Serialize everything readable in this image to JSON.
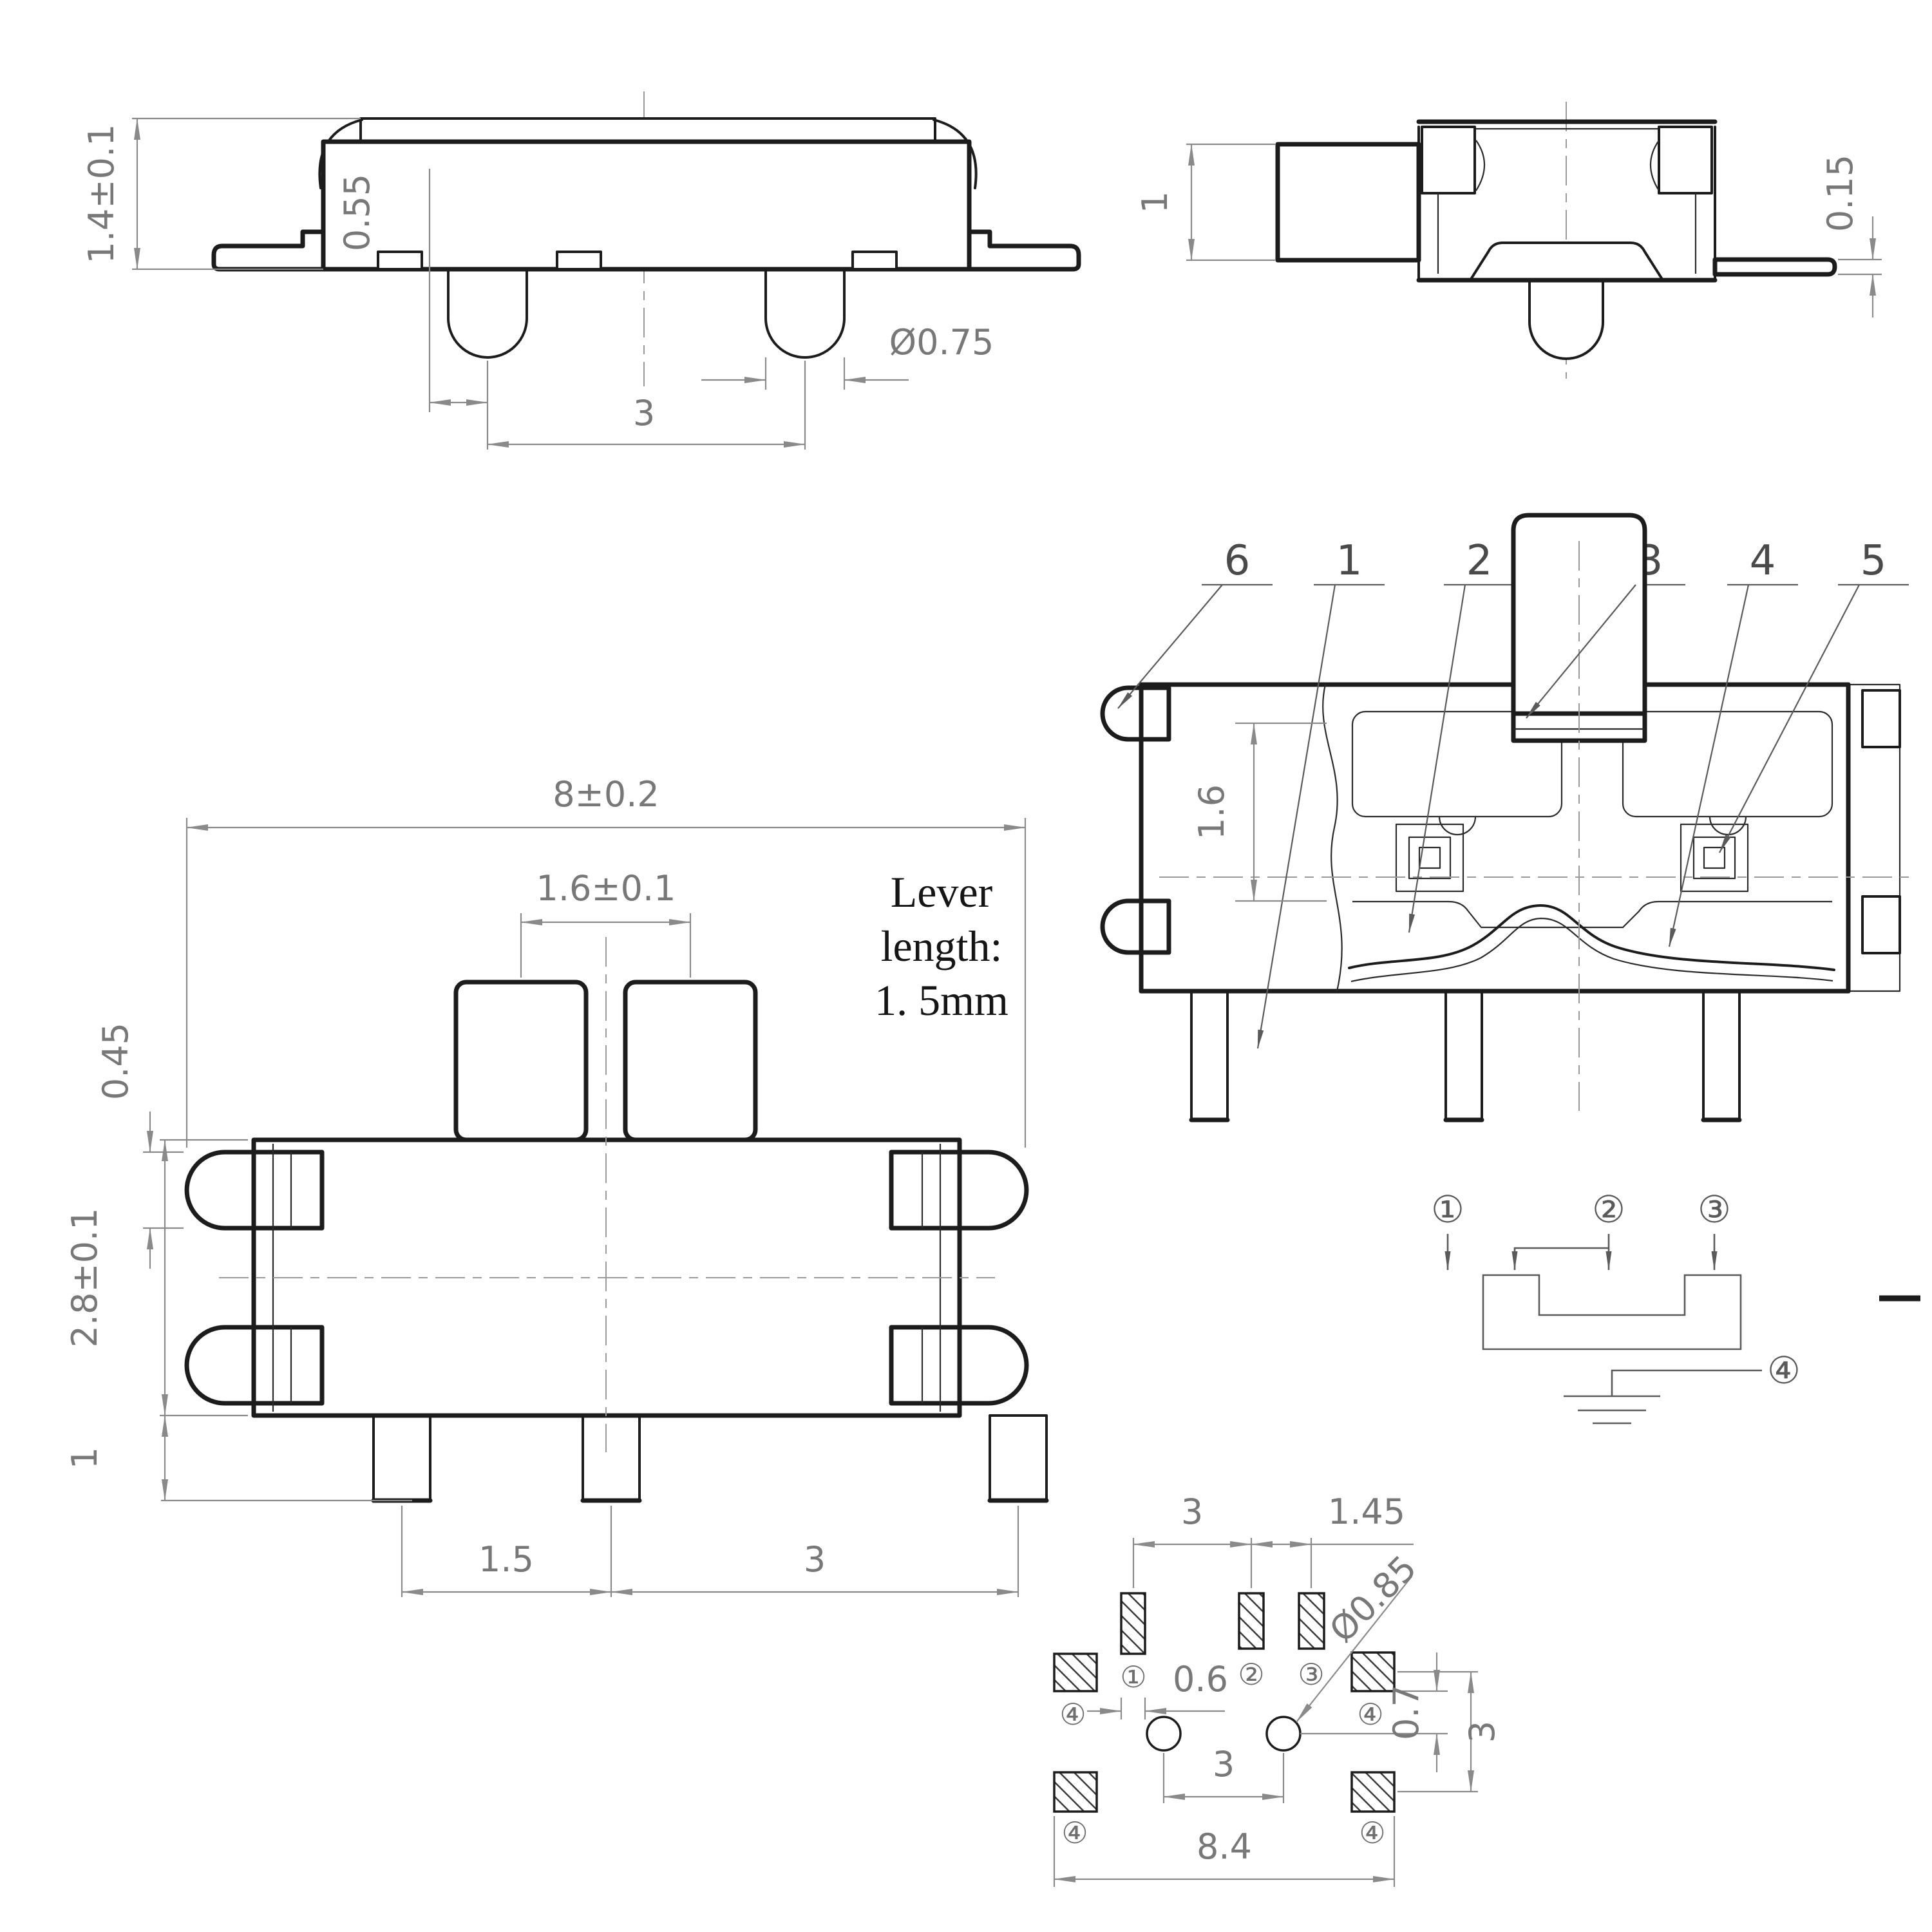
{
  "drawing": {
    "side": {
      "height": "1.4±0.1",
      "pin_offset": "0.55",
      "pin_dia": "Ø0.75",
      "pin_pitch": "3"
    },
    "end": {
      "lever_h": "1",
      "foot_t": "0.15"
    },
    "plan": {
      "width": "8±0.2",
      "knob_pitch": "1.6±0.1",
      "lug_h": "0.45",
      "body_h": "2.8±0.1",
      "leg_len": "1",
      "pitch12": "1.5",
      "pitch23": "3",
      "note1": "Lever",
      "note2": "length:",
      "note3": "1. 5mm"
    },
    "section": {
      "n6": "6",
      "n1": "1",
      "n2": "2",
      "n3": "3",
      "n4": "4",
      "n5": "5",
      "contact_h": "1.6"
    },
    "schematic": {
      "t1": "①",
      "t2": "②",
      "t3": "③",
      "t4": "④"
    },
    "footprint": {
      "pitch12": "3",
      "pitch23": "1.45",
      "hole_dia": "Ø0.85",
      "pad_w": "0.6",
      "hole_off": "0.7",
      "row_pitch": "3",
      "hole_pitch": "3",
      "overall": "8.4",
      "p1": "①",
      "p2": "②",
      "p3": "③",
      "p4": "④"
    }
  }
}
